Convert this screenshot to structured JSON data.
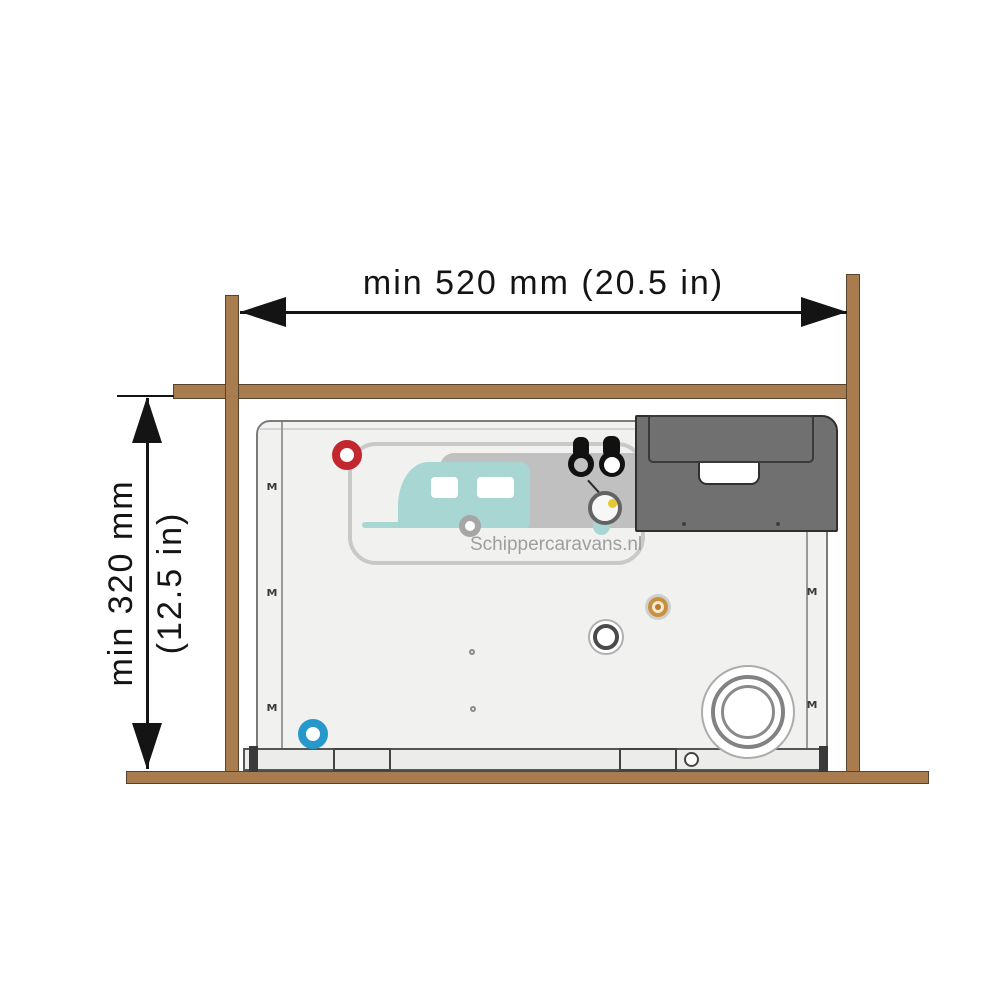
{
  "diagram": {
    "type": "installation-clearance-diagram",
    "dimensions": {
      "width_label": "min 520 mm (20.5 in)",
      "height_label_line1": "min 320 mm",
      "height_label_line2": "(12.5 in)"
    },
    "watermark_text": "Schippercaravans.nl",
    "clips": {
      "glyph": "M"
    },
    "colors": {
      "wood": "#A97C4F",
      "wood_outline": "#55432c",
      "arrow_black": "#141414",
      "body_fill": "#F1F1EF",
      "body_border": "#7b7b7b",
      "panel_dark": "#707070",
      "hot_port": "#C1272D",
      "cold_port": "#2798CC",
      "gas_port": "#C8913E",
      "yellow_dot": "#E6C832",
      "watermark_teal": "#A8D7D3",
      "watermark_gray": "#c9c9c9"
    }
  }
}
